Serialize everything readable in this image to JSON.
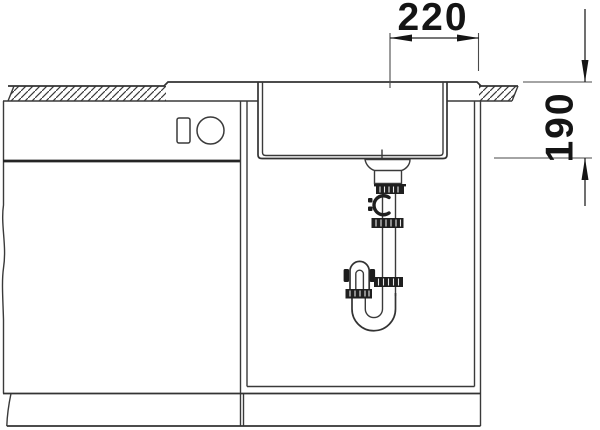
{
  "dimensions": {
    "width": {
      "value": "220"
    },
    "depth": {
      "value": "190"
    }
  },
  "colors": {
    "background": "#ffffff",
    "line": "#3a3a3a",
    "accent_dark": "#1f1f1f",
    "text": "#141414"
  }
}
